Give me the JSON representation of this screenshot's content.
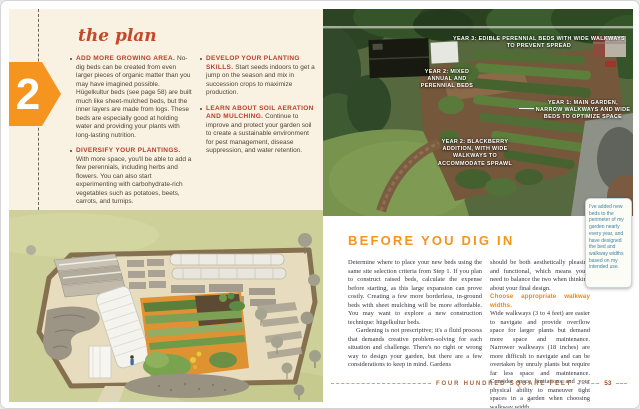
{
  "colors": {
    "accent_orange": "#f5941f",
    "brick_red": "#b5402a",
    "title_red": "#c3492b",
    "footer_brown": "#a8643a",
    "note_blue": "#3f80a4",
    "page_cream": "#f9f1e1"
  },
  "left_page": {
    "chapter_number": "2",
    "title": "the plan",
    "bullets": [
      {
        "heading": "ADD MORE GROWING AREA.",
        "body": "No-dig beds can be created from even larger pieces of organic matter than you may have imagined possible. Hügelkultur beds (see page 58) are built much like sheet-mulched beds, but the inner layers are made from logs. These beds are especially good at holding water and providing your plants with long-lasting nutrition."
      },
      {
        "heading": "DIVERSIFY YOUR PLANTINGS.",
        "body": "With more space, you'll be able to add a few perennials, including herbs and flowers. You can also start experimenting with carbohydrate-rich vegetables such as potatoes, beets, carrots, and turnips."
      },
      {
        "heading": "DEVELOP YOUR PLANTING SKILLS.",
        "body": "Start seeds indoors to get a jump on the season and mix in succession crops to maximize production."
      },
      {
        "heading": "LEARN ABOUT SOIL AERATION AND MULCHING.",
        "body": "Continue to improve and protect your garden soil to create a sustainable environment for pest management, disease suppression, and water retention."
      }
    ]
  },
  "right_page": {
    "photo_annotations": [
      "YEAR 3: EDIBLE PERENNIAL BEDS WITH WIDE WALKWAYS TO PREVENT SPREAD",
      "YEAR 2: MIXED ANNUAL AND PERENNIAL BEDS",
      "YEAR 1: MAIN GARDEN, NARROW WALKWAYS AND WIDE BEDS TO OPTIMIZE SPACE",
      "YEAR 2: BLACKBERRY ADDITION, WITH WIDE WALKWAYS TO ACCOMMODATE SPRAWL"
    ],
    "sticky_note": "I've added new beds to the perimeter of my garden nearly every year, and have designed the bed and walkway widths based on my intended use.",
    "section_title": "BEFORE YOU DIG IN",
    "col1_para1": "Determine where to place your new beds using the same site selection criteria from Step 1. If you plan to construct raised beds, calculate the expense before starting, as this large expansion can prove costly. Creating a few more borderless, in-ground beds with sheet mulching will be more affordable. You may want to explore a new construction technique: hügelkultur beds.",
    "col1_para2": "Gardening is not prescriptive; it's a fluid process that demands creative problem-solving for each situation and challenge. There's no right or wrong way to design your garden, but there are a few considerations to keep in mind. Gardens",
    "col2_para1": "should be both aesthetically pleasing and functional, which means you'll need to balance the two when thinking about your final design.",
    "col2_heading": "Choose appropriate walkway widths.",
    "col2_para2": "Wide walkways (3 to 4 feet) are easier to navigate and provide overflow space for larger plants but demand more space and maintenance. Narrower walkways (18 inches) are more difficult to navigate and can be overtaken by unruly plants but require far less space and maintenance. Consider space limitations and your physical ability to maneuver tight spaces in a garden when choosing walkway width.",
    "footer_label": "FOUR HUNDRED SQUARE FEET",
    "page_number": "53"
  }
}
